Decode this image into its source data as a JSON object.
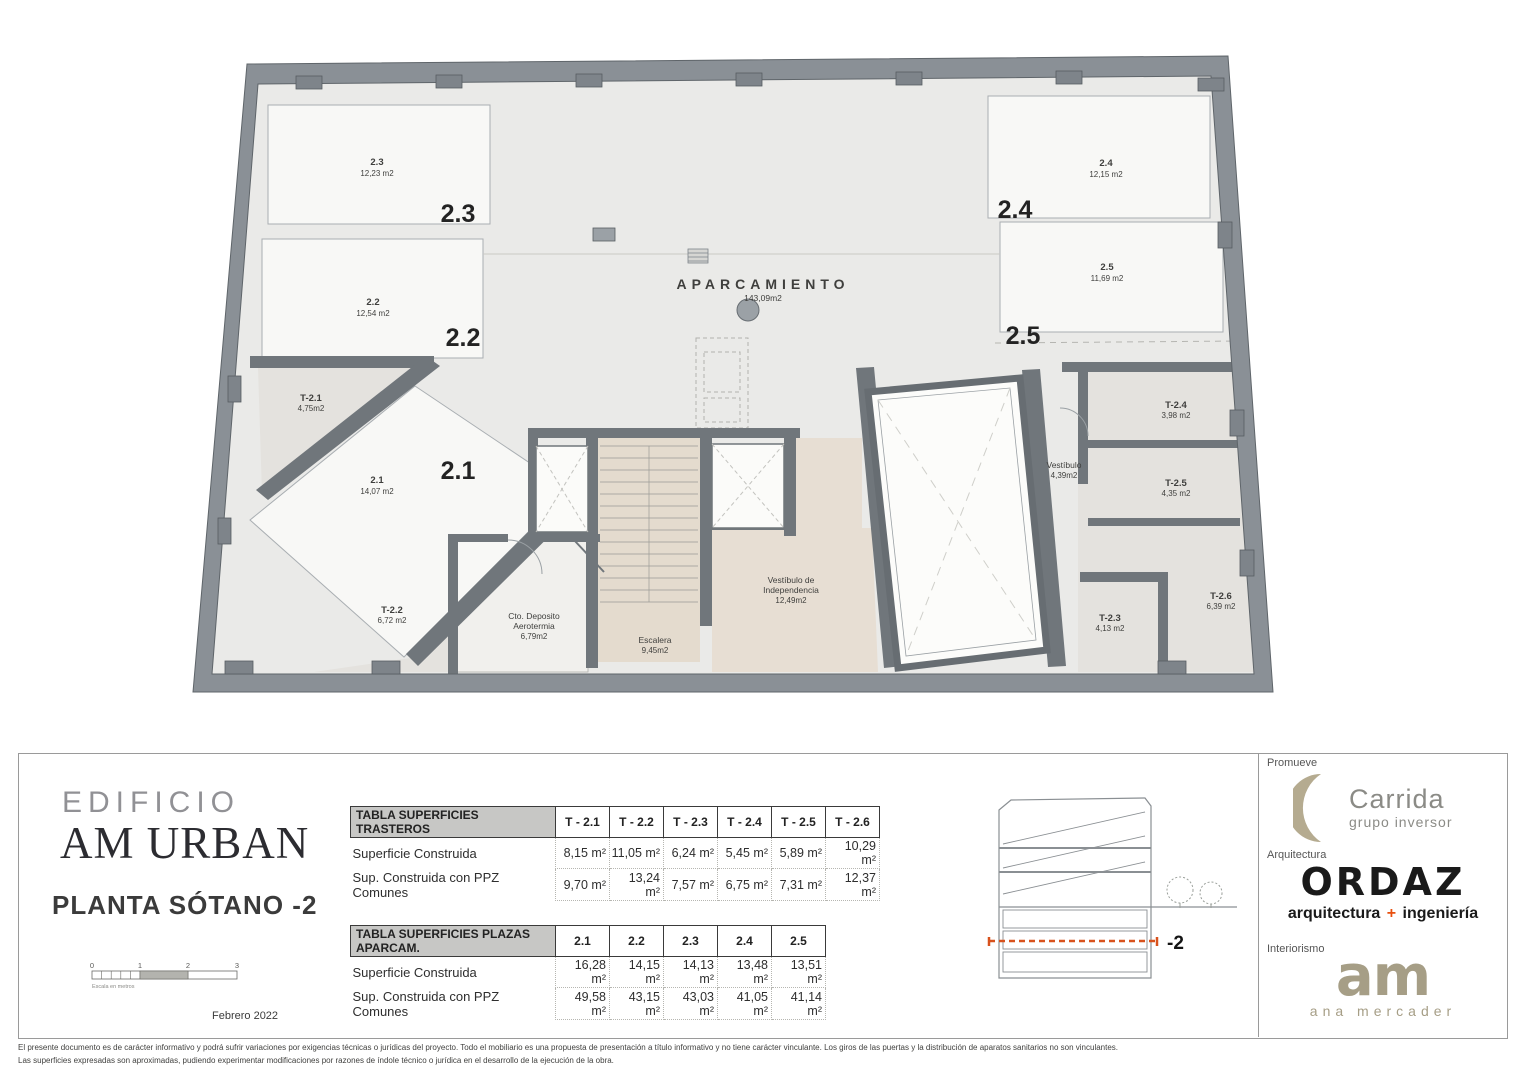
{
  "plan": {
    "aparcamiento": {
      "label": "APARCAMIENTO",
      "area": "143,09m2"
    },
    "parking_spaces": [
      {
        "id": "2.1",
        "area": "14,07 m2"
      },
      {
        "id": "2.2",
        "area": "12,54 m2"
      },
      {
        "id": "2.3",
        "area": "12,23 m2"
      },
      {
        "id": "2.4",
        "area": "12,15 m2"
      },
      {
        "id": "2.5",
        "area": "11,69 m2"
      }
    ],
    "trasteros": [
      {
        "id": "T-2.1",
        "area": "4,75m2"
      },
      {
        "id": "T-2.2",
        "area": "6,72 m2"
      },
      {
        "id": "T-2.3",
        "area": "4,13 m2"
      },
      {
        "id": "T-2.4",
        "area": "3,98 m2"
      },
      {
        "id": "T-2.5",
        "area": "4,35 m2"
      },
      {
        "id": "T-2.6",
        "area": "6,39 m2"
      }
    ],
    "rooms": [
      {
        "line1": "Cto. Deposito",
        "line2": "Aerotermia",
        "area": "6,79m2"
      },
      {
        "line1": "Escalera",
        "line2": "",
        "area": "9,45m2"
      },
      {
        "line1": "Vestíbulo de",
        "line2": "Independencia",
        "area": "12,49m2"
      },
      {
        "line1": "Vestíbulo",
        "line2": "",
        "area": "4,39m2"
      }
    ]
  },
  "title_block": {
    "project_line1": "EDIFICIO",
    "project_line2": "AM URBAN",
    "plan_title": "PLANTA SÓTANO -2",
    "date": "Febrero 2022",
    "scale_ticks": [
      "0",
      "1",
      "2",
      "3"
    ],
    "scale_caption": "Escala en metros"
  },
  "tables": [
    {
      "title": "TABLA SUPERFICIES TRASTEROS",
      "columns": [
        "T - 2.1",
        "T - 2.2",
        "T - 2.3",
        "T - 2.4",
        "T - 2.5",
        "T - 2.6"
      ],
      "rows": [
        {
          "label": "Superficie Construida",
          "values": [
            "8,15 m²",
            "11,05 m²",
            "6,24 m²",
            "5,45 m²",
            "5,89 m²",
            "10,29 m²"
          ]
        },
        {
          "label": "Sup. Construida con PPZ Comunes",
          "values": [
            "9,70 m²",
            "13,24 m²",
            "7,57 m²",
            "6,75 m²",
            "7,31 m²",
            "12,37 m²"
          ]
        }
      ]
    },
    {
      "title": "TABLA SUPERFICIES PLAZAS APARCAM.",
      "columns": [
        "2.1",
        "2.2",
        "2.3",
        "2.4",
        "2.5"
      ],
      "rows": [
        {
          "label": "Superficie Construida",
          "values": [
            "16,28 m²",
            "14,15 m²",
            "14,13 m²",
            "13,48 m²",
            "13,51 m²"
          ]
        },
        {
          "label": "Sup. Construida con PPZ Comunes",
          "values": [
            "49,58 m²",
            "43,15 m²",
            "43,03 m²",
            "41,05 m²",
            "41,14 m²"
          ]
        }
      ]
    }
  ],
  "section_diagram": {
    "level_label": "-2"
  },
  "credits": [
    {
      "role": "Promueve",
      "name": "Carrida",
      "subtitle": "grupo inversor"
    },
    {
      "role": "Arquitectura",
      "name": "ORDAZ",
      "subtitle_pre": "arquitectura ",
      "subtitle_plus": "+",
      "subtitle_post": " ingeniería"
    },
    {
      "role": "Interiorismo",
      "name": "am",
      "subtitle": "ana mercader"
    }
  ],
  "disclaimer": {
    "line1": "El presente documento es de carácter informativo y podrá sufrir variaciones por exigencias técnicas o jurídicas del proyecto. Todo el mobiliario es una propuesta de presentación a título informativo y no tiene carácter vinculante. Los giros de las puertas y la distribución de aparatos sanitarios no son vinculantes.",
    "line2": "Las superficies expresadas son aproximadas, pudiendo experimentar modificaciones por razones de índole técnico o jurídica en el desarrollo de la ejecución de la obra."
  },
  "colors": {
    "wall_gray": "#8a9096",
    "interior_wall": "#70767b",
    "floor_gray": "#eaeae8",
    "floor_beige": "#e4dbce",
    "accent_orange": "#d8521d",
    "carrida_tan": "#b5ab90",
    "am_tan": "#a69e86",
    "ordaz_black": "#1a1a1a"
  }
}
